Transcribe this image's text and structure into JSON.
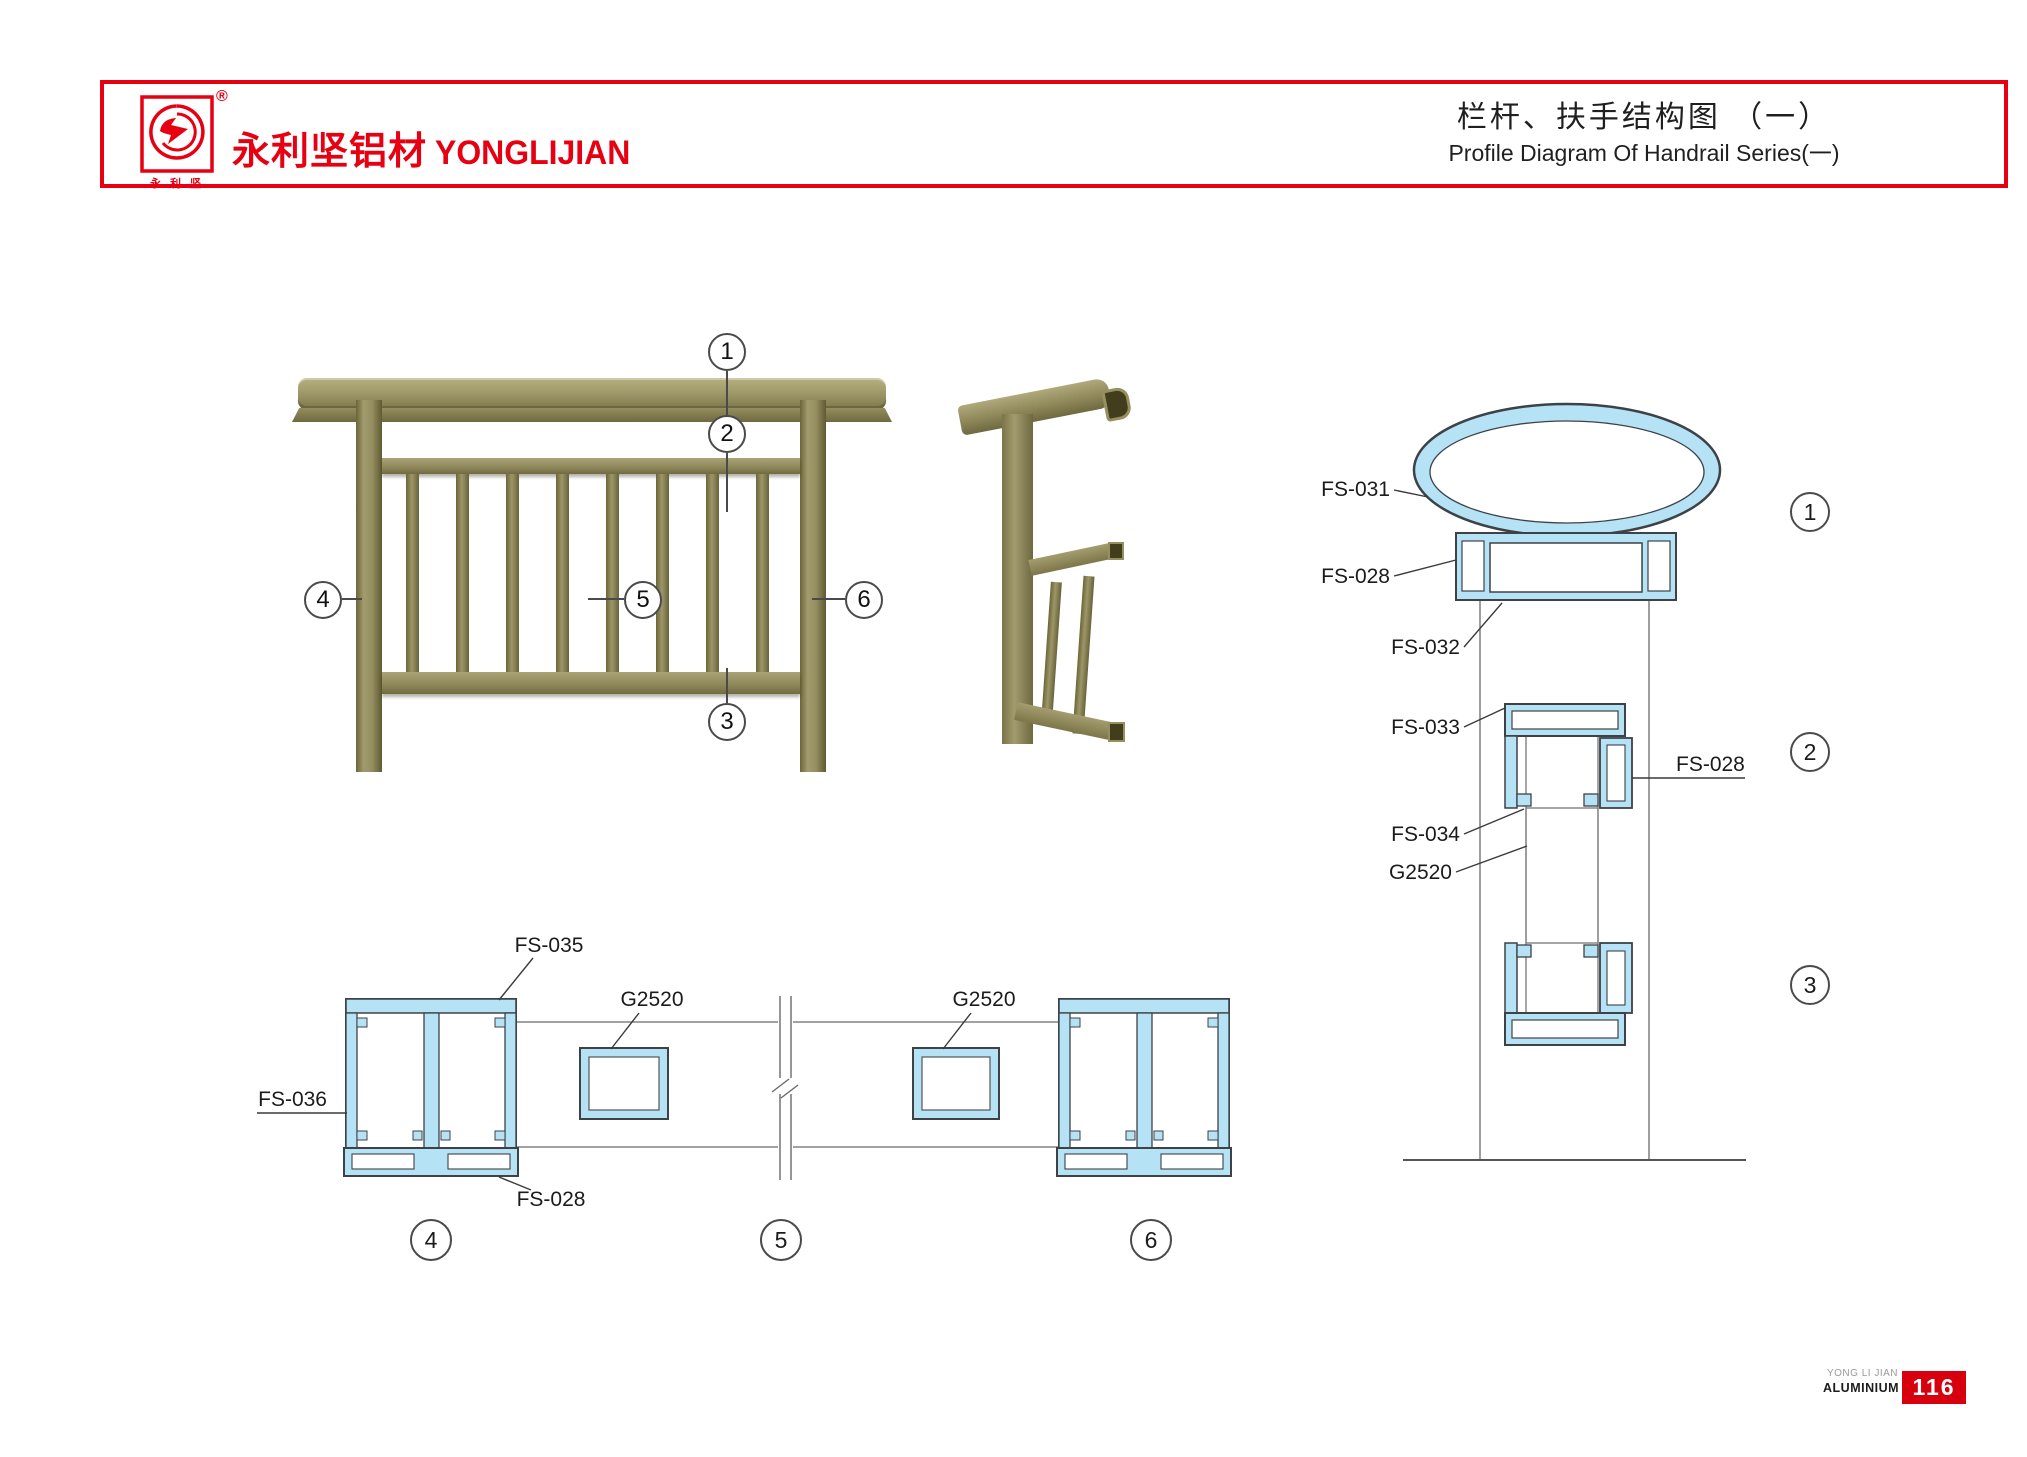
{
  "header": {
    "logo_monogram": "Y",
    "logo_caption": "永 利 坚",
    "registered_mark": "®",
    "brand_cn": "永利坚铝材",
    "brand_en": "YONGLIJIAN",
    "title_cn": "栏杆、扶手结构图 （一）",
    "title_en": "Profile Diagram Of Handrail Series(一)"
  },
  "callouts": {
    "n1": "1",
    "n2": "2",
    "n3": "3",
    "n4": "4",
    "n5": "5",
    "n6": "6"
  },
  "part_labels": {
    "fs031": "FS-031",
    "fs028_rail": "FS-028",
    "fs032": "FS-032",
    "fs033": "FS-033",
    "fs028_mid": "FS-028",
    "fs034": "FS-034",
    "g2520_mid": "G2520",
    "fs035": "FS-035",
    "fs036": "FS-036",
    "fs028_post": "FS-028",
    "g2520_left": "G2520",
    "g2520_right": "G2520"
  },
  "footer": {
    "brand_line1": "YONG LI JIAN",
    "brand_line2": "ALUMINIUM",
    "page_number": "116"
  },
  "colors": {
    "brand_red": "#e60012",
    "page_number_red": "#d7000f",
    "profile_fill": "#b5e2f5",
    "profile_stroke": "#3d4247",
    "railing_olive": "#958e60"
  }
}
